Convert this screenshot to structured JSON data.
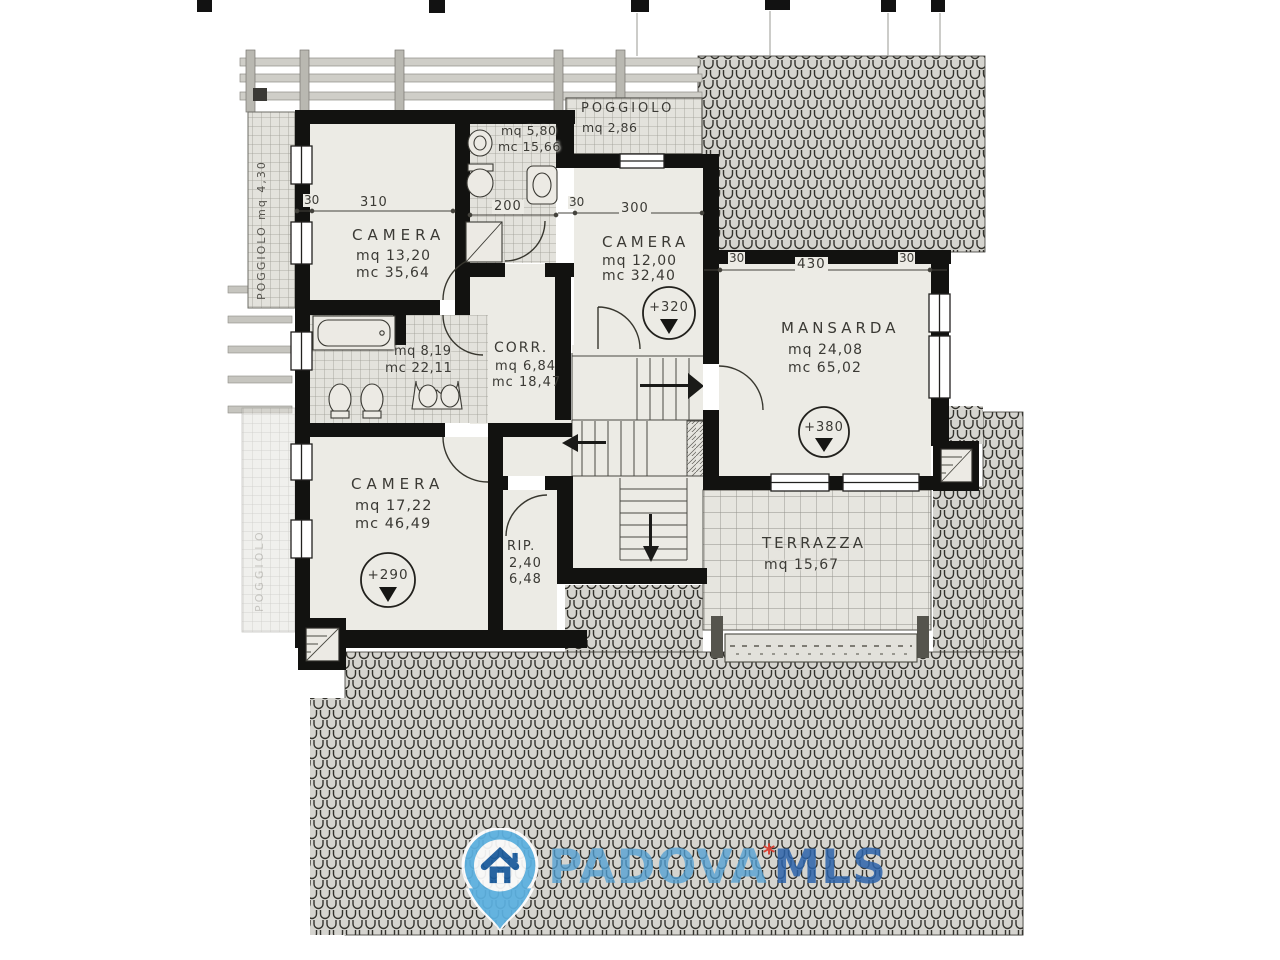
{
  "plan": {
    "rooms": {
      "camera_nw": {
        "name": "CAMERA",
        "area": "mq 13,20",
        "volume": "mc 35,64"
      },
      "bagno_top": {
        "area": "mq 5,80",
        "volume": "mc 15,66"
      },
      "poggiolo_top": {
        "name": "POGGIOLO",
        "area": "mq 2,86"
      },
      "camera_n": {
        "name": "CAMERA",
        "area": "mq 12,00",
        "volume": "mc 32,40",
        "level": "+320"
      },
      "mansarda": {
        "name": "MANSARDA",
        "area": "mq 24,08",
        "volume": "mc 65,02",
        "level": "+380"
      },
      "bagno_mid": {
        "area": "mq 8,19",
        "volume": "mc 22,11"
      },
      "corridoio": {
        "name": "CORR.",
        "area": "mq 6,84",
        "volume": "mc 18,47"
      },
      "camera_sw": {
        "name": "CAMERA",
        "area": "mq 17,22",
        "volume": "mc 46,49",
        "level": "+290"
      },
      "ripostiglio": {
        "name": "RIP.",
        "area": "2,40",
        "volume": "6,48"
      },
      "terrazza": {
        "name": "TERRAZZA",
        "area": "mq 15,67"
      },
      "poggiolo_left": {
        "label": "POGGIOLO mq 4,30"
      },
      "poggiolo_left_lower": {
        "label": "POGGIOLO"
      }
    },
    "dimensions": {
      "d30_nw": "30",
      "d310": "310",
      "d200": "200",
      "d30_n": "30",
      "d300": "300",
      "d30_m_l": "30",
      "d430": "430",
      "d30_m_r": "30"
    }
  },
  "watermark": {
    "brand_primary": "PADOVA",
    "brand_secondary": "MLS",
    "star": "*",
    "pin_color": "#5cb1e1",
    "house_color": "#1b5c9e",
    "star_color": "#d93a2c"
  }
}
